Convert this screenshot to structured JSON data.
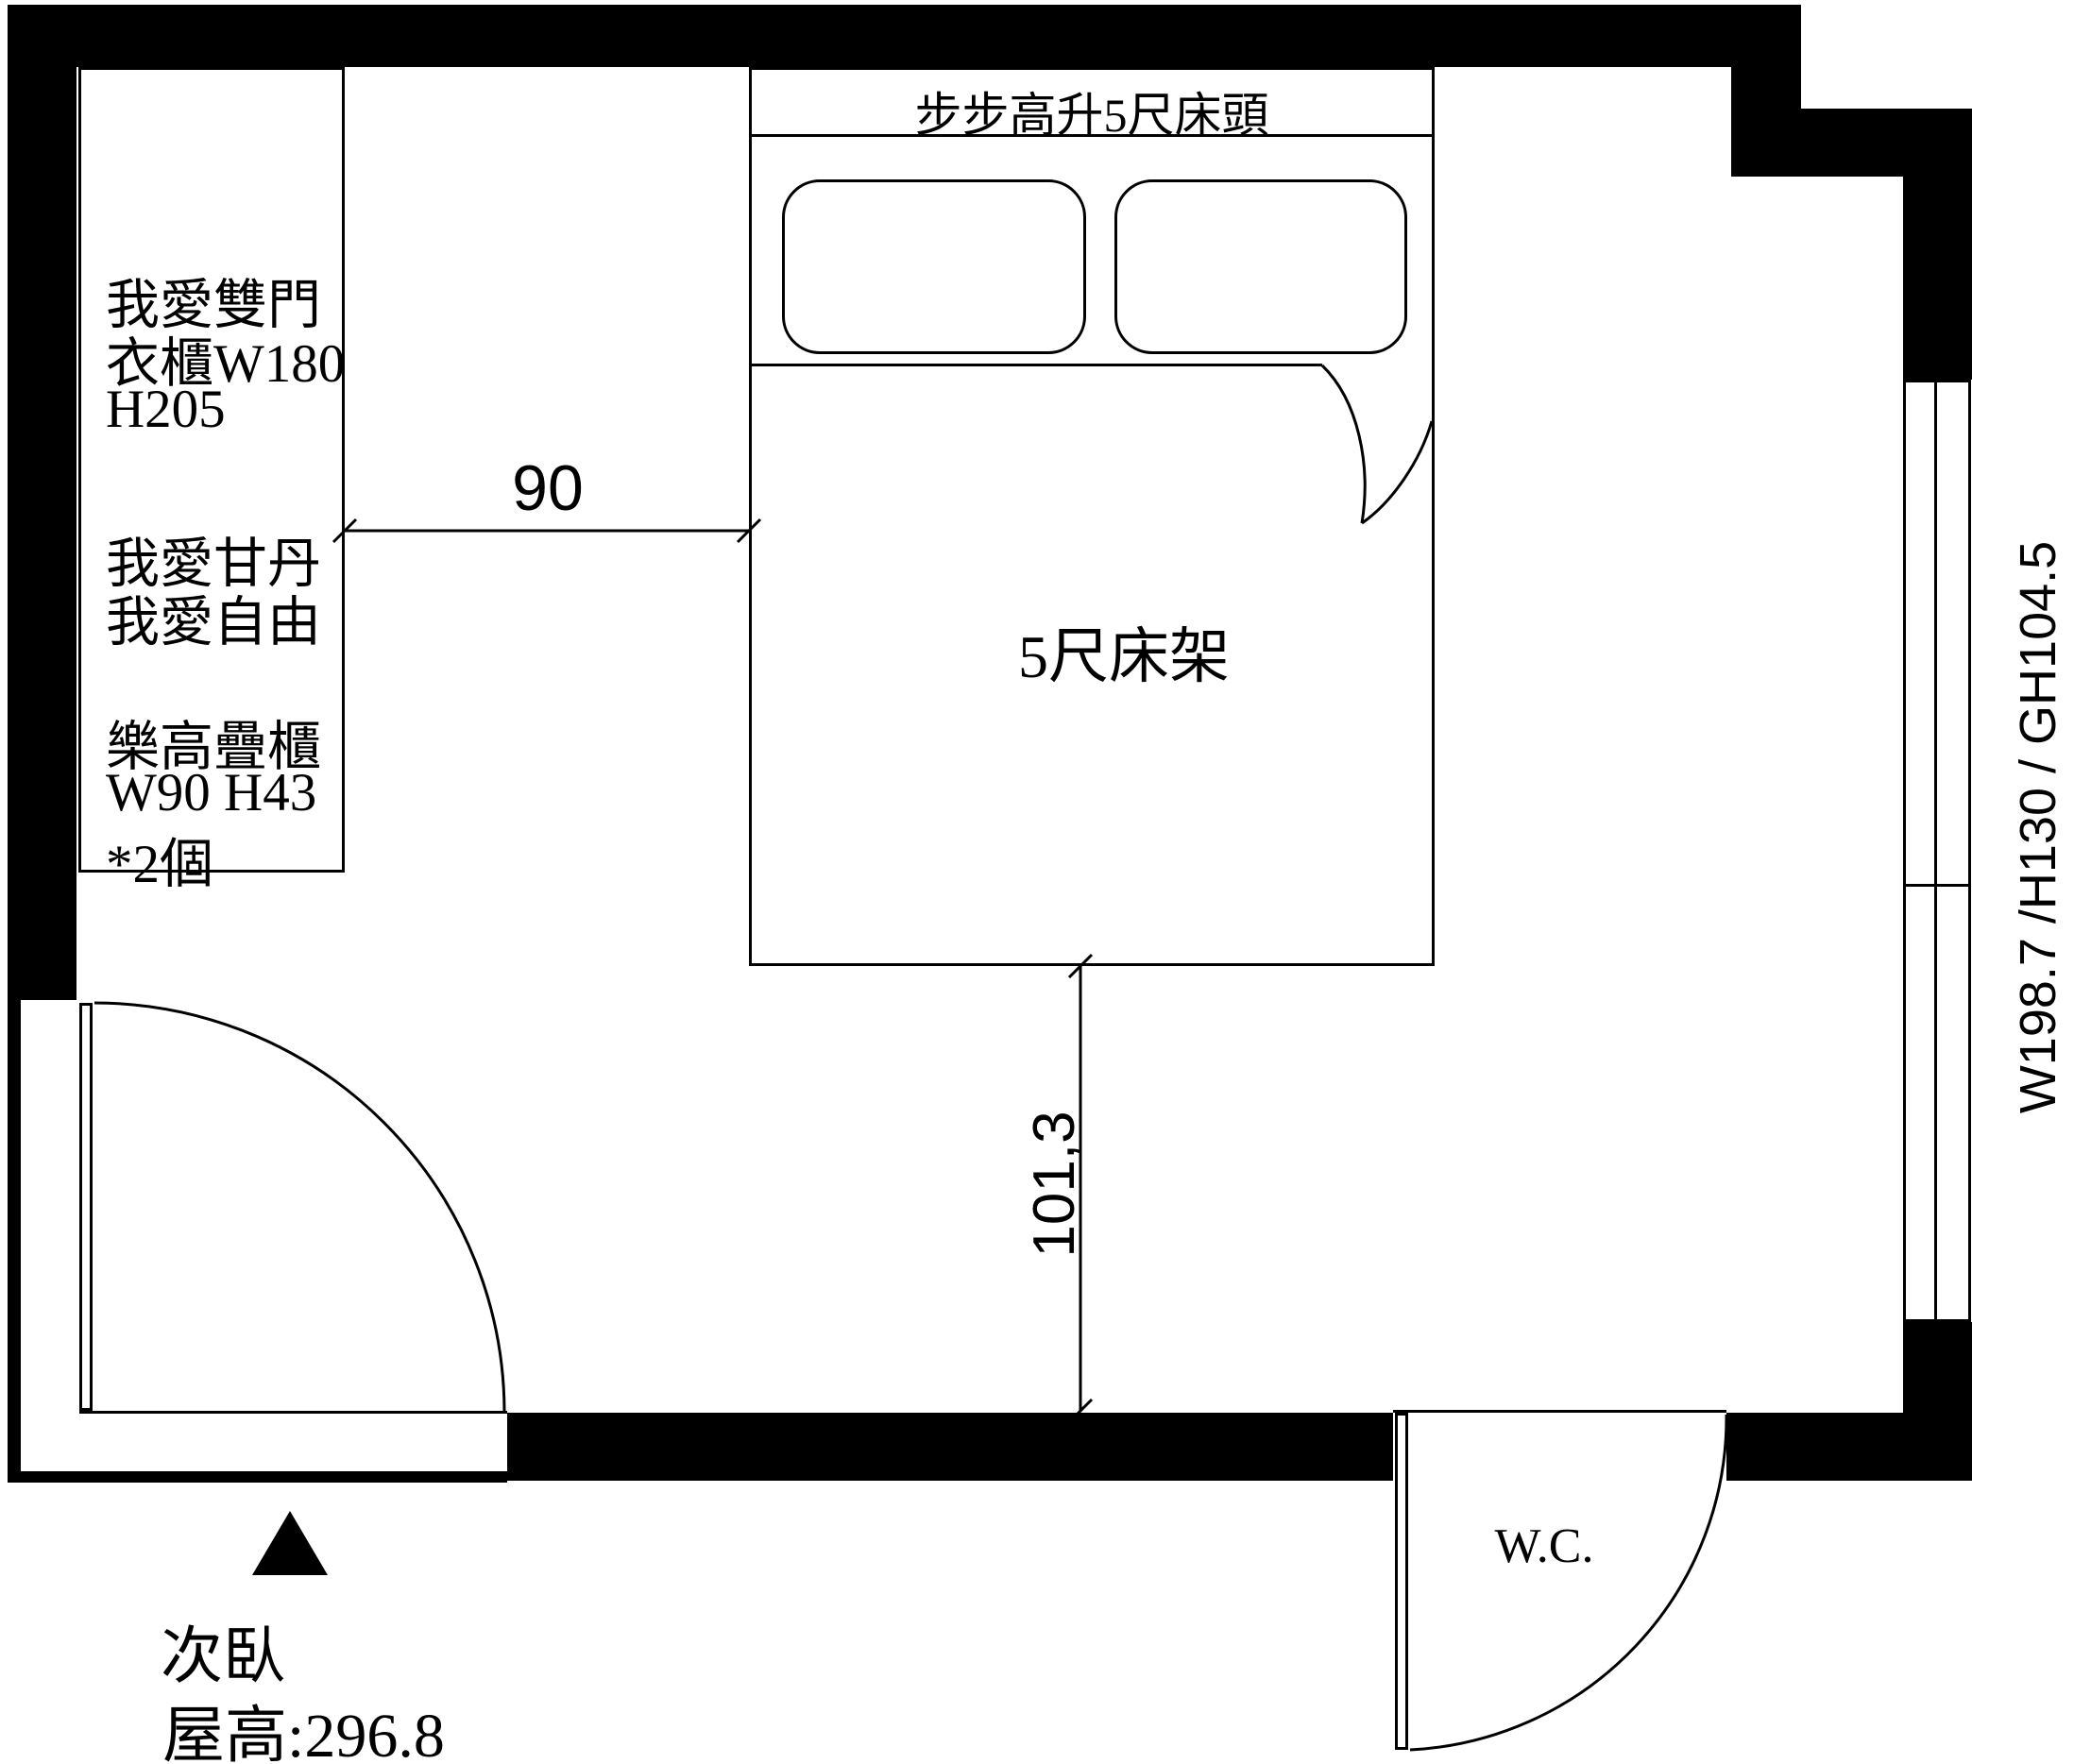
{
  "title": "次臥平面圖",
  "wardrobe_note": {
    "lines": [
      "我愛雙門",
      "衣櫃W180",
      "H205",
      "我愛甘丹",
      "我愛自由",
      "樂高疊櫃",
      "W90 H43",
      "*2個"
    ]
  },
  "bed": {
    "headboard_label": "步步高升5尺床頭",
    "frame_label": "5尺床架"
  },
  "dimensions": {
    "horizontal": "90",
    "vertical": "101,3"
  },
  "window_label": "W198.7 /H130 / GH104.5",
  "wc_label": "W.C.",
  "room": {
    "name": "次臥",
    "ceiling_height": "屋高:296.8"
  },
  "colors": {
    "line": "#000000",
    "background": "#ffffff"
  }
}
